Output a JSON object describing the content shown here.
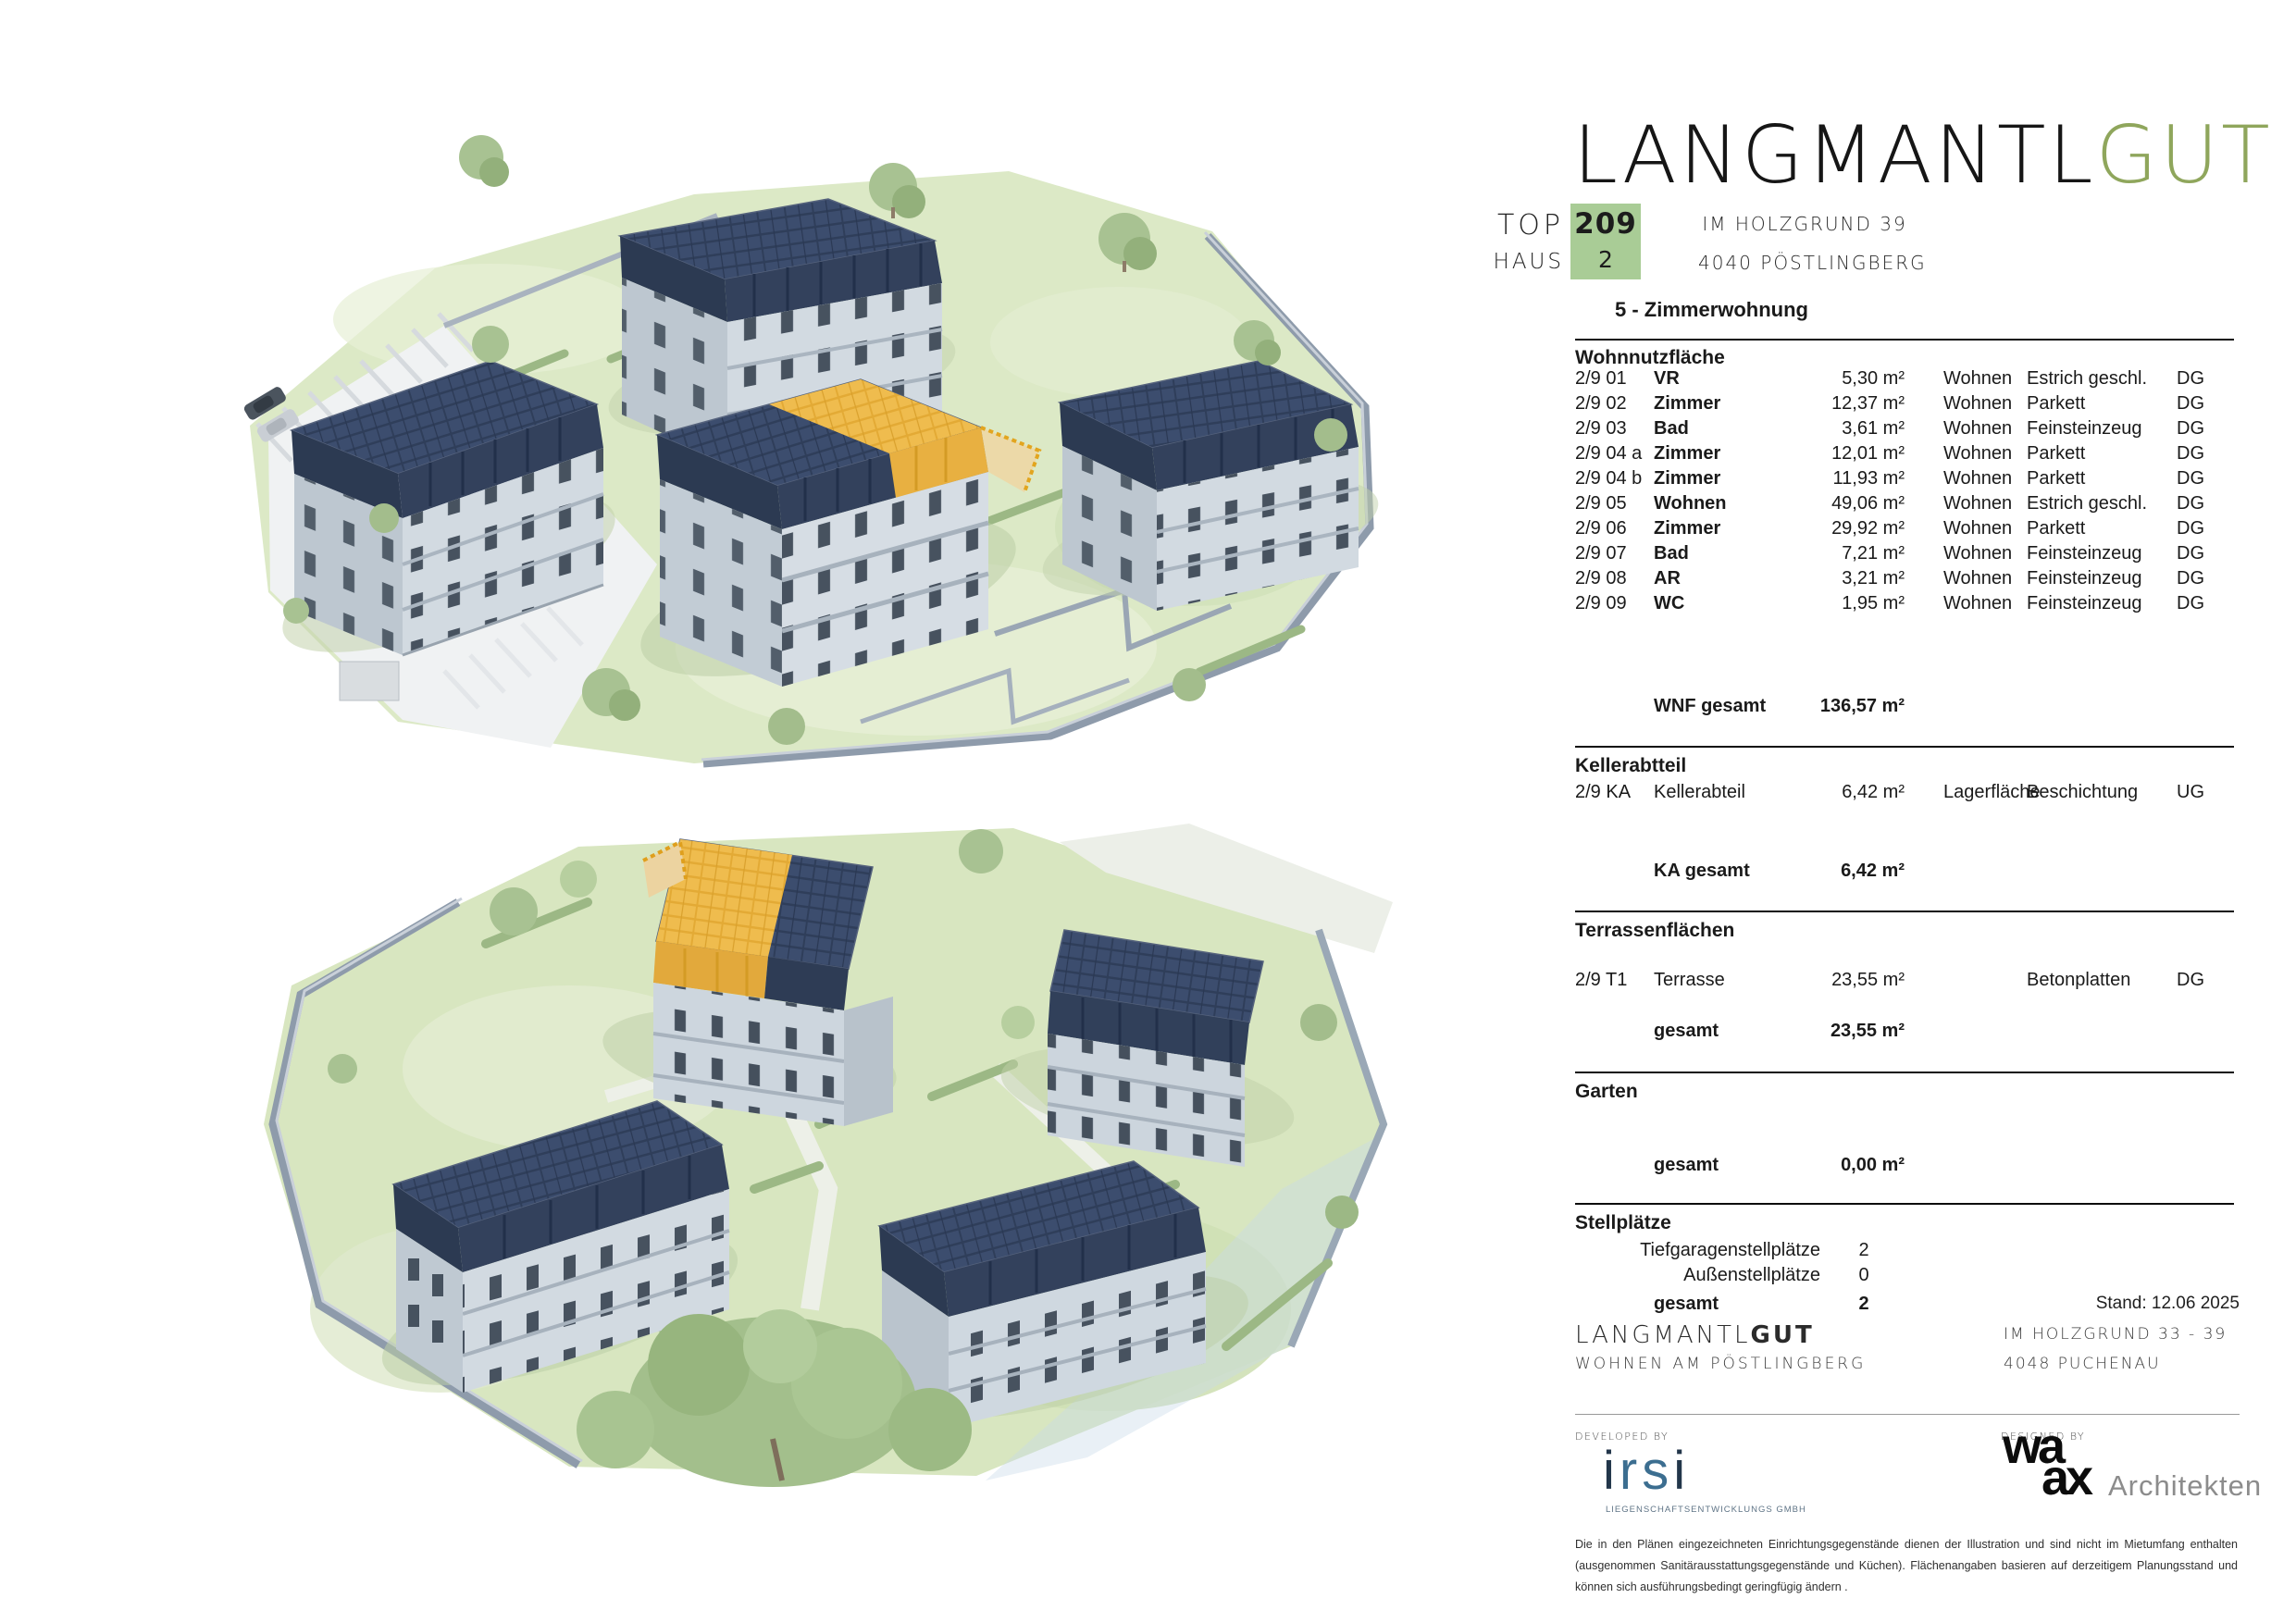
{
  "brand": {
    "black": "LANGMANTL",
    "green": "GUT",
    "green_hex": "#8fa65c"
  },
  "header": {
    "top_label": "TOP",
    "top_value": "209",
    "haus_label": "HAUS",
    "haus_value": "2",
    "badge_color": "#a9cc96",
    "address_line1": "IM HOLZGRUND 39",
    "address_line2": "4040 PÖSTLINGBERG",
    "unit_type": "5 - Zimmerwohnung"
  },
  "colors": {
    "highlight_roof": "#edb549",
    "solar_roof": "#33415c",
    "badge_green": "#a9cc96",
    "brand_green": "#8fa65c",
    "irsi_blue": "#3c6e90"
  },
  "renderings": {
    "top_name": "aerial-site-rendering-view-1",
    "bottom_name": "aerial-site-rendering-view-2"
  },
  "sections": {
    "wohnnutzflaeche": {
      "title": "Wohnnutzfläche",
      "rows": [
        {
          "nr": "2/9 01",
          "room": "VR",
          "area": "5,30 m²",
          "zone": "Wohnen",
          "finish": "Estrich geschl.",
          "level": "DG"
        },
        {
          "nr": "2/9 02",
          "room": "Zimmer",
          "area": "12,37 m²",
          "zone": "Wohnen",
          "finish": "Parkett",
          "level": "DG"
        },
        {
          "nr": "2/9 03",
          "room": "Bad",
          "area": "3,61 m²",
          "zone": "Wohnen",
          "finish": "Feinsteinzeug",
          "level": "DG"
        },
        {
          "nr": "2/9 04 a",
          "room": "Zimmer",
          "area": "12,01 m²",
          "zone": "Wohnen",
          "finish": "Parkett",
          "level": "DG"
        },
        {
          "nr": "2/9 04 b",
          "room": "Zimmer",
          "area": "11,93 m²",
          "zone": "Wohnen",
          "finish": "Parkett",
          "level": "DG"
        },
        {
          "nr": "2/9 05",
          "room": "Wohnen",
          "area": "49,06 m²",
          "zone": "Wohnen",
          "finish": "Estrich geschl.",
          "level": "DG"
        },
        {
          "nr": "2/9 06",
          "room": "Zimmer",
          "area": "29,92 m²",
          "zone": "Wohnen",
          "finish": "Parkett",
          "level": "DG"
        },
        {
          "nr": "2/9 07",
          "room": "Bad",
          "area": "7,21 m²",
          "zone": "Wohnen",
          "finish": "Feinsteinzeug",
          "level": "DG"
        },
        {
          "nr": "2/9 08",
          "room": "AR",
          "area": "3,21 m²",
          "zone": "Wohnen",
          "finish": "Feinsteinzeug",
          "level": "DG"
        },
        {
          "nr": "2/9 09",
          "room": "WC",
          "area": "1,95 m²",
          "zone": "Wohnen",
          "finish": "Feinsteinzeug",
          "level": "DG"
        }
      ],
      "total_label": "WNF gesamt",
      "total_value": "136,57 m²"
    },
    "keller": {
      "title": "Kellerabtteil",
      "row": {
        "nr": "2/9 KA",
        "room": "Kellerabteil",
        "area": "6,42 m²",
        "zone": "Lagerfläche",
        "finish": "Beschichtung",
        "level": "UG"
      },
      "total_label": "KA gesamt",
      "total_value": "6,42 m²"
    },
    "terrassen": {
      "title": "Terrassenflächen",
      "row": {
        "nr": "2/9 T1",
        "room": "Terrasse",
        "area": "23,55 m²",
        "zone": "",
        "finish": "Betonplatten",
        "level": "DG"
      },
      "total_label": "gesamt",
      "total_value": "23,55 m²"
    },
    "garten": {
      "title": "Garten",
      "total_label": "gesamt",
      "total_value": "0,00 m²"
    },
    "stellplaetze": {
      "title": "Stellplätze",
      "items": [
        {
          "label": "Tiefgaragenstellplätze",
          "value": "2"
        },
        {
          "label": "Außenstellplätze",
          "value": "0"
        }
      ],
      "total_label": "gesamt",
      "total_value": "2"
    }
  },
  "stand": "Stand: 12.06 2025",
  "footer": {
    "brand_black": "LANGMANTL",
    "brand_bold": "GUT",
    "tagline": "WOHNEN AM PÖSTLINGBERG",
    "address_line1": "IM HOLZGRUND 33 - 39",
    "address_line2": "4048 PUCHENAU",
    "developed_by": "DEVELOPED BY",
    "designed_by": "DESIGNED BY",
    "irsi_i1": "i",
    "irsi_r": "r",
    "irsi_s": "s",
    "irsi_i2": "i",
    "irsi_sub": "LIEGENSCHAFTSENTWICKLUNGS GMBH",
    "waax_wa": "wa",
    "waax_ax": "ax",
    "waax_name": "Architekten",
    "disclaimer": "Die in den Plänen eingezeichneten Einrichtungsgegenstände dienen der Illustration und sind nicht im Mietumfang enthalten (ausgenommen Sanitärausstattungsgegenstände und Küchen). Flächenangaben basieren auf derzeitigem Planungsstand und können sich ausführungsbedingt geringfügig ändern ."
  }
}
